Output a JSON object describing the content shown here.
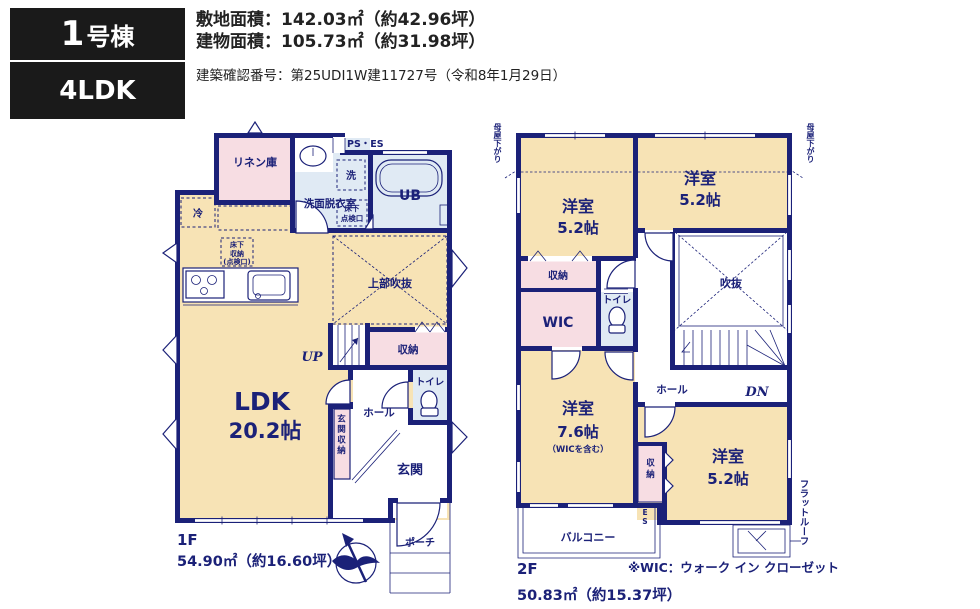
{
  "header": {
    "unit_number": "1",
    "unit_suffix": "号棟",
    "layout_type": "4LDK",
    "site_area": "敷地面積：142.03㎡（約42.96坪）",
    "building_area": "建物面積：105.73㎡（約31.98坪）",
    "confirmation": "建築確認番号：第25UDI1W建11727号（令和8年1月29日）"
  },
  "floor1": {
    "label": "1F",
    "area": "54.90㎡（約16.60坪）",
    "ldk_name": "LDK",
    "ldk_size": "20.2帖",
    "linen": "リネン庫",
    "fridge": "冷",
    "washer": "洗",
    "sanitary": "洗面脱衣室",
    "ps_es": "PS・ES",
    "ub": "UB",
    "hatch_line1": "床下",
    "hatch_line2": "点検口",
    "storage_hatch_line1": "床下",
    "storage_hatch_line2": "収納",
    "storage_hatch_line3": "(点検口)",
    "void_above": "上部吹抜",
    "up": "UP",
    "storage": "収納",
    "toilet": "トイレ",
    "hall": "ホール",
    "entrance_storage": "玄関収納",
    "entrance": "玄関",
    "porch": "ポーチ"
  },
  "floor2": {
    "label": "2F",
    "area": "50.83㎡（約15.37坪）",
    "note": "※WIC：ウォーク イン クローゼット",
    "room_nw_name": "洋室",
    "room_nw_size": "5.2帖",
    "room_ne_name": "洋室",
    "room_ne_size": "5.2帖",
    "room_sw_name": "洋室",
    "room_sw_size": "7.6帖",
    "room_sw_note": "（WICを含む）",
    "room_se_name": "洋室",
    "room_se_size": "5.2帖",
    "void": "吹抜",
    "hall": "ホール",
    "dn": "DN",
    "storage_n": "収納",
    "wic": "WIC",
    "toilet": "トイレ",
    "storage_s": "収納",
    "balcony": "バルコニー",
    "es": "ES",
    "flat_roof": "フラットルーフ",
    "moya_sagari_left": "母屋下がり",
    "moya_sagari_right": "母屋下がり"
  },
  "colors": {
    "wall_navy": "#1b2178",
    "room_tan": "#f7e3b5",
    "closet_pink": "#f7dde3",
    "wet_area_blue": "#e0eaf4",
    "header_black": "#1a1a1a",
    "text_dark": "#222222"
  }
}
